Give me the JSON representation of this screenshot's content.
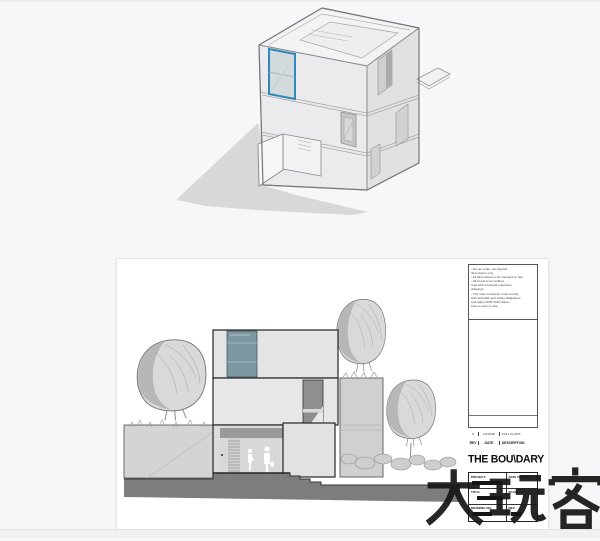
{
  "colors": {
    "page_background": "#f7f7f9",
    "selection_highlight": "#2e88b8",
    "glazing": "#7d97a1",
    "ground": "#7d7d7d",
    "sheet_white": "#ffffff",
    "watermark_ink": "#161616"
  },
  "sheet": {
    "titleblock": {
      "notes": [
        "- Do not scale, use figured",
        "  dimensions only.",
        "- All dimensions to be checked on site",
        "- All levels to be verified,",
        "  read with structural engineers",
        "  drawings.",
        "- The main contractor must comply",
        "  with all health and safety obligations",
        "  and apply CDM 2015 duties,",
        "  prior to start on site."
      ],
      "revision_entry": {
        "rev": "A",
        "date": "13/10/20",
        "description": "FULL PLANS"
      },
      "revision_header": {
        "rev": "REV",
        "date": "DATE",
        "description": "DESCRIPTION"
      },
      "logo": "THE BOU\\DARY",
      "fields": {
        "project_label": "PROJECT:",
        "date_of_issue_label": "DATE OF ISSUE:",
        "title_label": "TITLE:",
        "scale_label": "SCALE:",
        "drawing_no_label": "DRAWING NO:",
        "rev_label": "REV:"
      }
    }
  },
  "watermark": {
    "text": "大玩客"
  }
}
